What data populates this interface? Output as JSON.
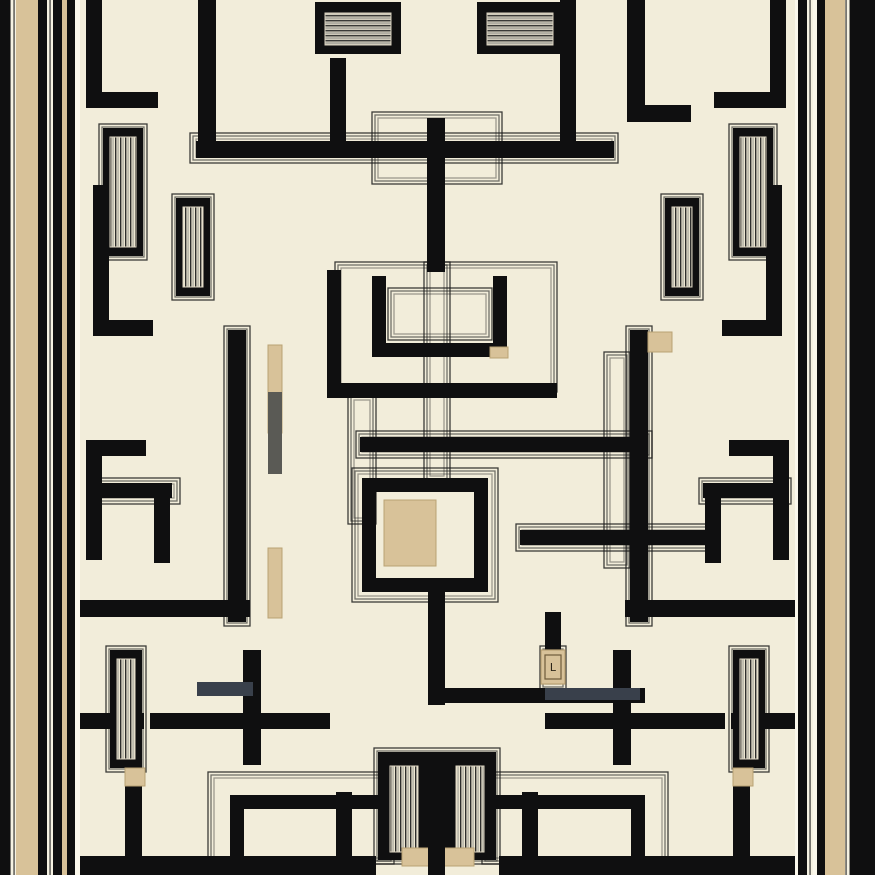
{
  "artwork": {
    "canvas": {
      "width": 875,
      "height": 875
    },
    "palette": {
      "cream": "#F2EDDA",
      "cream_bright": "#FBF8EC",
      "black": "#0F0F10",
      "tan": "#D8C299",
      "tan_dark": "#B9A274",
      "gray": "#5A5A55",
      "slate": "#39404B",
      "line": "#1C1C1C"
    },
    "border_bands": {
      "left": [
        {
          "x": 0,
          "w": 10,
          "kind": "black"
        },
        {
          "x": 10,
          "w": 6,
          "kind": "pin"
        },
        {
          "x": 16,
          "w": 22,
          "kind": "tan"
        },
        {
          "x": 38,
          "w": 9,
          "kind": "black"
        },
        {
          "x": 47,
          "w": 6,
          "kind": "pin"
        },
        {
          "x": 53,
          "w": 9,
          "kind": "black"
        },
        {
          "x": 62,
          "w": 5,
          "kind": "tan"
        },
        {
          "x": 67,
          "w": 8,
          "kind": "black"
        },
        {
          "x": 75,
          "w": 5,
          "kind": "cream"
        }
      ],
      "right": [
        {
          "x": 795,
          "w": 3,
          "kind": "cream"
        },
        {
          "x": 798,
          "w": 9,
          "kind": "black"
        },
        {
          "x": 807,
          "w": 6,
          "kind": "pin"
        },
        {
          "x": 813,
          "w": 4,
          "kind": "cream"
        },
        {
          "x": 817,
          "w": 8,
          "kind": "black"
        },
        {
          "x": 825,
          "w": 20,
          "kind": "tan"
        },
        {
          "x": 845,
          "w": 5,
          "kind": "pin"
        },
        {
          "x": 850,
          "w": 25,
          "kind": "black"
        }
      ]
    },
    "walls": [
      [
        86,
        0,
        16,
        108
      ],
      [
        86,
        92,
        72,
        16
      ],
      [
        198,
        0,
        18,
        158
      ],
      [
        196,
        141,
        418,
        17
      ],
      [
        330,
        58,
        16,
        85
      ],
      [
        560,
        0,
        16,
        148
      ],
      [
        627,
        0,
        18,
        122
      ],
      [
        627,
        105,
        64,
        17
      ],
      [
        770,
        0,
        16,
        108
      ],
      [
        714,
        92,
        72,
        16
      ],
      [
        427,
        118,
        18,
        154
      ],
      [
        327,
        270,
        14,
        120
      ],
      [
        327,
        383,
        230,
        15
      ],
      [
        372,
        276,
        14,
        81
      ],
      [
        493,
        276,
        14,
        81
      ],
      [
        372,
        343,
        135,
        14
      ],
      [
        93,
        185,
        16,
        150
      ],
      [
        93,
        320,
        60,
        16
      ],
      [
        766,
        185,
        16,
        150
      ],
      [
        722,
        320,
        60,
        16
      ],
      [
        86,
        440,
        16,
        120
      ],
      [
        86,
        440,
        60,
        16
      ],
      [
        92,
        483,
        80,
        15
      ],
      [
        154,
        483,
        16,
        80
      ],
      [
        773,
        440,
        16,
        120
      ],
      [
        729,
        440,
        60,
        16
      ],
      [
        703,
        483,
        80,
        15
      ],
      [
        705,
        483,
        16,
        80
      ],
      [
        228,
        330,
        18,
        292
      ],
      [
        630,
        330,
        18,
        292
      ],
      [
        80,
        600,
        170,
        17
      ],
      [
        625,
        600,
        170,
        17
      ],
      [
        360,
        437,
        288,
        15
      ],
      [
        520,
        530,
        190,
        15
      ],
      [
        632,
        437,
        16,
        108
      ],
      [
        362,
        478,
        126,
        14
      ],
      [
        362,
        478,
        14,
        114
      ],
      [
        362,
        578,
        126,
        14
      ],
      [
        474,
        492,
        14,
        100
      ],
      [
        545,
        612,
        16,
        48
      ],
      [
        428,
        585,
        17,
        120
      ],
      [
        445,
        688,
        200,
        15
      ],
      [
        243,
        650,
        18,
        115
      ],
      [
        613,
        650,
        18,
        115
      ],
      [
        150,
        713,
        180,
        16
      ],
      [
        545,
        713,
        180,
        16
      ],
      [
        60,
        713,
        84,
        16
      ],
      [
        731,
        713,
        84,
        16
      ],
      [
        125,
        775,
        17,
        95
      ],
      [
        733,
        775,
        17,
        95
      ],
      [
        230,
        795,
        150,
        14
      ],
      [
        230,
        795,
        14,
        70
      ],
      [
        495,
        795,
        150,
        14
      ],
      [
        631,
        795,
        14,
        70
      ],
      [
        336,
        792,
        16,
        66
      ],
      [
        522,
        792,
        16,
        66
      ],
      [
        80,
        856,
        296,
        19
      ],
      [
        499,
        856,
        296,
        19
      ],
      [
        378,
        752,
        118,
        108
      ]
    ],
    "overlay_walls": [
      [
        428,
        800,
        17,
        60
      ],
      [
        428,
        845,
        17,
        30
      ]
    ],
    "pinstripe_frames": [
      [
        335,
        262,
        222,
        130
      ],
      [
        388,
        288,
        104,
        52
      ],
      [
        372,
        112,
        130,
        72
      ],
      [
        190,
        133,
        428,
        30
      ],
      [
        352,
        468,
        146,
        134
      ],
      [
        604,
        352,
        26,
        216
      ],
      [
        224,
        326,
        26,
        300
      ],
      [
        626,
        326,
        26,
        300
      ],
      [
        424,
        262,
        26,
        220
      ],
      [
        99,
        124,
        48,
        136
      ],
      [
        172,
        194,
        42,
        106
      ],
      [
        729,
        124,
        48,
        136
      ],
      [
        661,
        194,
        42,
        106
      ],
      [
        106,
        646,
        40,
        126
      ],
      [
        729,
        646,
        40,
        126
      ],
      [
        88,
        478,
        92,
        26
      ],
      [
        699,
        478,
        92,
        26
      ],
      [
        356,
        431,
        296,
        27
      ],
      [
        516,
        524,
        198,
        27
      ],
      [
        208,
        772,
        186,
        92
      ],
      [
        482,
        772,
        186,
        92
      ],
      [
        374,
        748,
        126,
        116
      ],
      [
        348,
        394,
        28,
        130
      ],
      [
        540,
        646,
        26,
        44
      ]
    ],
    "fluted_columns": [
      [
        103,
        128,
        40,
        128
      ],
      [
        176,
        198,
        34,
        98
      ],
      [
        733,
        128,
        40,
        128
      ],
      [
        665,
        198,
        34,
        98
      ],
      [
        110,
        650,
        32,
        118
      ],
      [
        733,
        650,
        32,
        118
      ]
    ],
    "flute_inners": [
      [
        390,
        766,
        28,
        86
      ],
      [
        456,
        766,
        28,
        86
      ]
    ],
    "hatch_blocks": [
      [
        315,
        2,
        86,
        52
      ],
      [
        477,
        2,
        86,
        52
      ]
    ],
    "tan_accents": [
      [
        384,
        500,
        52,
        66
      ],
      [
        268,
        345,
        14,
        88
      ],
      [
        268,
        548,
        14,
        70
      ],
      [
        402,
        848,
        72,
        18
      ],
      [
        125,
        768,
        20,
        18
      ],
      [
        733,
        768,
        20,
        18
      ],
      [
        648,
        332,
        24,
        20
      ],
      [
        490,
        347,
        18,
        11
      ]
    ],
    "gray_accents": [
      {
        "rect": [
          268,
          392,
          14,
          82
        ],
        "color": "gray"
      },
      {
        "rect": [
          197,
          682,
          56,
          14
        ],
        "color": "slate"
      },
      {
        "rect": [
          545,
          688,
          95,
          12
        ],
        "color": "slate"
      }
    ],
    "plaque": {
      "x": 541,
      "y": 650,
      "w": 24,
      "h": 34,
      "glyph": "L"
    }
  }
}
